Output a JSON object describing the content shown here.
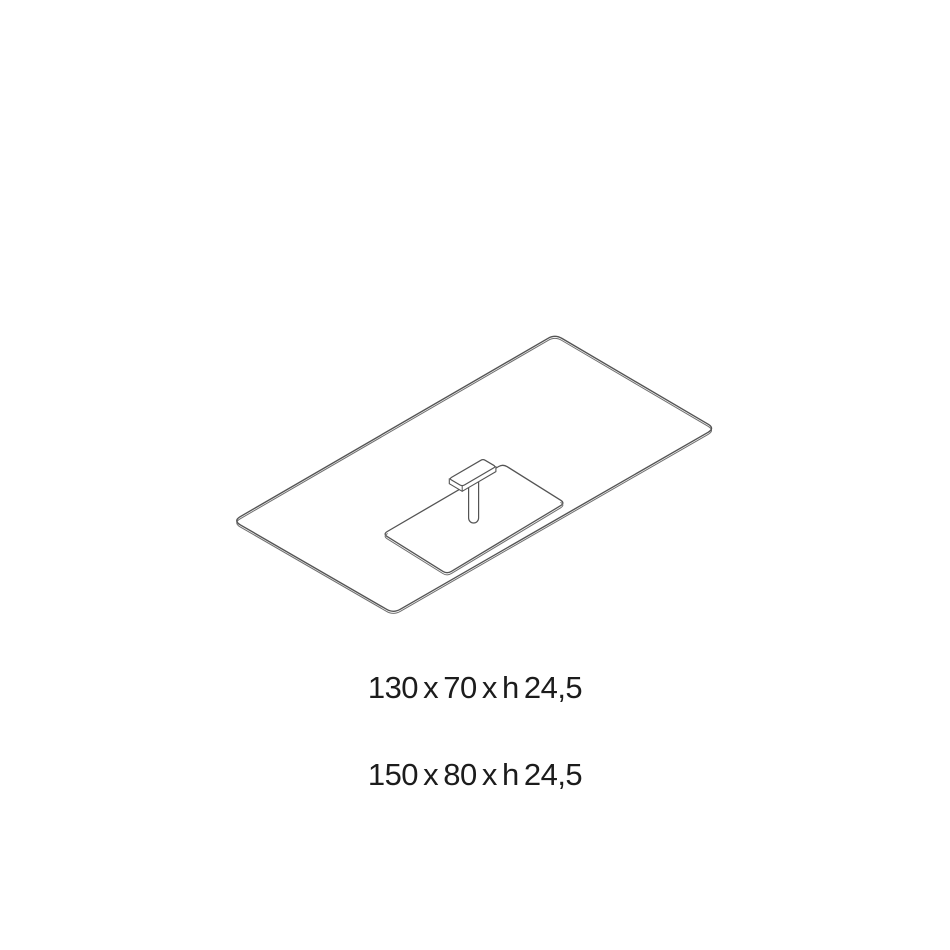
{
  "page": {
    "background_color": "#ffffff"
  },
  "figure": {
    "description": "Isometric technical line drawing of a rectangular top with integrated basin underside and drain pipe",
    "line_color": "#545454",
    "secondary_line_color": "#6f6f6f",
    "text_color": "#1c1c1c"
  },
  "dimensions": {
    "line1": "130 x 70 x h 24,5",
    "line2": "150 x 80 x h 24,5"
  }
}
